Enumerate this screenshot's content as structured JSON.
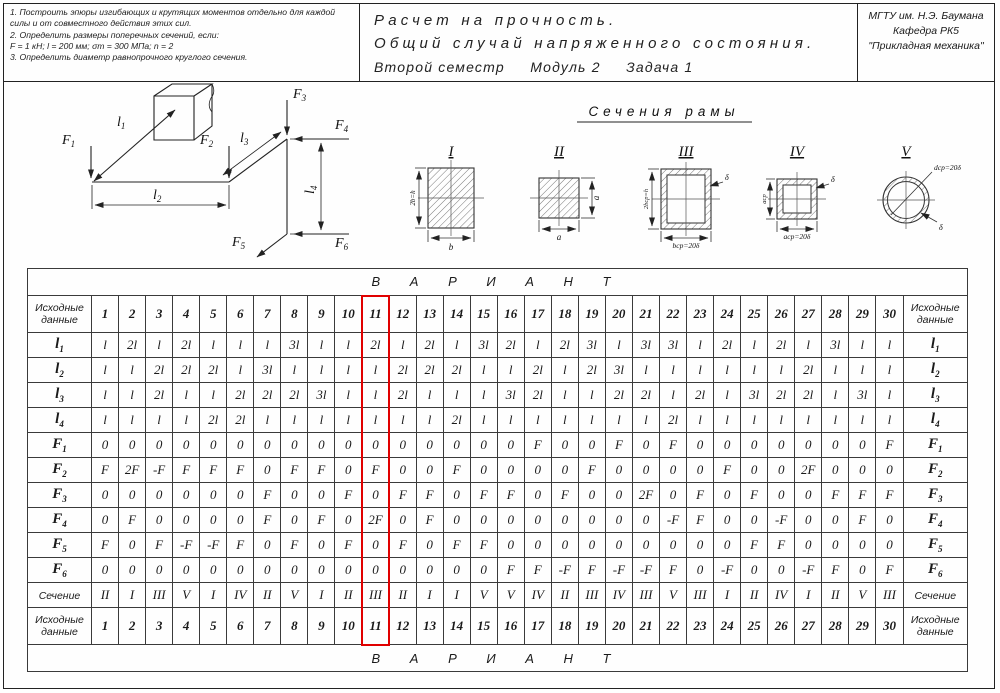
{
  "header": {
    "tasks": [
      "1. Построить эпюры изгибающих и крутящих моментов отдельно для каждой силы и от совместного действия этих сил.",
      "2. Определить размеры поперечных сечений, если:",
      "F = 1 кН;  l = 200 мм;  σт = 300 МПа;  n = 2",
      "3. Определить диаметр равнопрочного круглого сечения."
    ],
    "title_line1": "Расчет на прочность.",
    "title_line2": "Общий случай напряженного состояния.",
    "title_line3": "Второй семестр     Модуль 2     Задача 1",
    "org_line1": "МГТУ им. Н.Э. Баумана",
    "org_line2": "Кафедра РК5",
    "org_line3": "\"Прикладная механика\""
  },
  "drawing": {
    "sections_title": "Сечения рамы",
    "frame": {
      "forces": [
        {
          "base": "F",
          "sub": "1"
        },
        {
          "base": "F",
          "sub": "2"
        },
        {
          "base": "F",
          "sub": "3"
        },
        {
          "base": "F",
          "sub": "4"
        },
        {
          "base": "F",
          "sub": "5"
        },
        {
          "base": "F",
          "sub": "6"
        }
      ],
      "lengths": [
        {
          "base": "l",
          "sub": "1"
        },
        {
          "base": "l",
          "sub": "2"
        },
        {
          "base": "l",
          "sub": "3"
        },
        {
          "base": "l",
          "sub": "4"
        }
      ]
    },
    "sections": [
      {
        "numeral": "I",
        "dim_left": "2b=h",
        "dim_bottom": "b"
      },
      {
        "numeral": "II",
        "dim_right": "a",
        "dim_bottom": "a"
      },
      {
        "numeral": "III",
        "dim_left": "2bср=h",
        "dim_bottom": "bср=20δ",
        "dim_thickness": "δ"
      },
      {
        "numeral": "IV",
        "dim_left": "aср",
        "dim_bottom": "aср=20δ",
        "dim_thickness": "δ"
      },
      {
        "numeral": "V",
        "dim_diameter": "dср=20δ",
        "dim_thickness": "δ"
      }
    ]
  },
  "table": {
    "banner": "В А Р И А Н Т",
    "corner_label": "Исходные данные",
    "variants": [
      "1",
      "2",
      "3",
      "4",
      "5",
      "6",
      "7",
      "8",
      "9",
      "10",
      "11",
      "12",
      "13",
      "14",
      "15",
      "16",
      "17",
      "18",
      "19",
      "20",
      "21",
      "22",
      "23",
      "24",
      "25",
      "26",
      "27",
      "28",
      "29",
      "30"
    ],
    "rows": [
      {
        "label_base": "l",
        "label_sub": "1",
        "values": [
          "l",
          "2l",
          "l",
          "2l",
          "l",
          "l",
          "l",
          "3l",
          "l",
          "l",
          "2l",
          "l",
          "2l",
          "l",
          "3l",
          "2l",
          "l",
          "2l",
          "3l",
          "l",
          "3l",
          "3l",
          "l",
          "2l",
          "l",
          "2l",
          "l",
          "3l",
          "l",
          "l"
        ]
      },
      {
        "label_base": "l",
        "label_sub": "2",
        "values": [
          "l",
          "l",
          "2l",
          "2l",
          "2l",
          "l",
          "3l",
          "l",
          "l",
          "l",
          "l",
          "2l",
          "2l",
          "2l",
          "l",
          "l",
          "2l",
          "l",
          "2l",
          "3l",
          "l",
          "l",
          "l",
          "l",
          "l",
          "l",
          "2l",
          "l",
          "l",
          "l"
        ]
      },
      {
        "label_base": "l",
        "label_sub": "3",
        "values": [
          "l",
          "l",
          "2l",
          "l",
          "l",
          "2l",
          "2l",
          "2l",
          "3l",
          "l",
          "l",
          "2l",
          "l",
          "l",
          "l",
          "3l",
          "2l",
          "l",
          "l",
          "2l",
          "2l",
          "l",
          "2l",
          "l",
          "3l",
          "2l",
          "2l",
          "l",
          "3l",
          "l"
        ]
      },
      {
        "label_base": "l",
        "label_sub": "4",
        "values": [
          "l",
          "l",
          "l",
          "l",
          "2l",
          "2l",
          "l",
          "l",
          "l",
          "l",
          "l",
          "l",
          "l",
          "2l",
          "l",
          "l",
          "l",
          "l",
          "l",
          "l",
          "l",
          "2l",
          "l",
          "l",
          "l",
          "l",
          "l",
          "l",
          "l",
          "l"
        ]
      },
      {
        "label_base": "F",
        "label_sub": "1",
        "values": [
          "0",
          "0",
          "0",
          "0",
          "0",
          "0",
          "0",
          "0",
          "0",
          "0",
          "0",
          "0",
          "0",
          "0",
          "0",
          "0",
          "F",
          "0",
          "0",
          "F",
          "0",
          "F",
          "0",
          "0",
          "0",
          "0",
          "0",
          "0",
          "0",
          "F"
        ]
      },
      {
        "label_base": "F",
        "label_sub": "2",
        "values": [
          "F",
          "2F",
          "-F",
          "F",
          "F",
          "F",
          "0",
          "F",
          "F",
          "0",
          "F",
          "0",
          "0",
          "F",
          "0",
          "0",
          "0",
          "0",
          "F",
          "0",
          "0",
          "0",
          "0",
          "F",
          "0",
          "0",
          "2F",
          "0",
          "0",
          "0"
        ]
      },
      {
        "label_base": "F",
        "label_sub": "3",
        "values": [
          "0",
          "0",
          "0",
          "0",
          "0",
          "0",
          "F",
          "0",
          "0",
          "F",
          "0",
          "F",
          "F",
          "0",
          "F",
          "F",
          "0",
          "F",
          "0",
          "0",
          "2F",
          "0",
          "F",
          "0",
          "F",
          "0",
          "0",
          "F",
          "F",
          "F"
        ]
      },
      {
        "label_base": "F",
        "label_sub": "4",
        "values": [
          "0",
          "F",
          "0",
          "0",
          "0",
          "0",
          "F",
          "0",
          "F",
          "0",
          "2F",
          "0",
          "F",
          "0",
          "0",
          "0",
          "0",
          "0",
          "0",
          "0",
          "0",
          "-F",
          "F",
          "0",
          "0",
          "-F",
          "0",
          "0",
          "F",
          "0"
        ]
      },
      {
        "label_base": "F",
        "label_sub": "5",
        "values": [
          "F",
          "0",
          "F",
          "-F",
          "-F",
          "F",
          "0",
          "F",
          "0",
          "F",
          "0",
          "F",
          "0",
          "F",
          "F",
          "0",
          "0",
          "0",
          "0",
          "0",
          "0",
          "0",
          "0",
          "0",
          "F",
          "F",
          "0",
          "0",
          "0",
          "0"
        ]
      },
      {
        "label_base": "F",
        "label_sub": "6",
        "values": [
          "0",
          "0",
          "0",
          "0",
          "0",
          "0",
          "0",
          "0",
          "0",
          "0",
          "0",
          "0",
          "0",
          "0",
          "0",
          "F",
          "F",
          "-F",
          "F",
          "-F",
          "-F",
          "F",
          "0",
          "-F",
          "0",
          "0",
          "-F",
          "F",
          "0",
          "F"
        ]
      },
      {
        "label_base": "Сечение",
        "label_sub": "",
        "values": [
          "II",
          "I",
          "III",
          "V",
          "I",
          "IV",
          "II",
          "V",
          "I",
          "II",
          "III",
          "II",
          "I",
          "I",
          "V",
          "V",
          "IV",
          "II",
          "III",
          "IV",
          "III",
          "V",
          "III",
          "I",
          "II",
          "IV",
          "I",
          "II",
          "V",
          "III"
        ]
      }
    ],
    "highlight": {
      "column": 11,
      "color": "#e00000"
    }
  }
}
